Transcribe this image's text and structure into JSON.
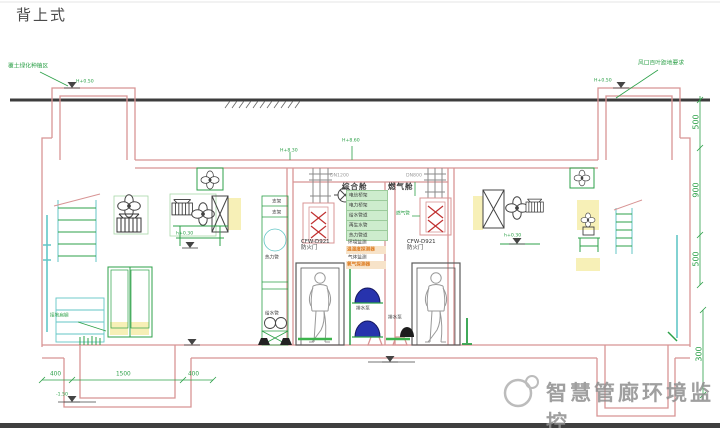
{
  "title": "背上式",
  "watermark": {
    "text": "智慧管廊环境监控"
  },
  "cabins": {
    "left": "综合舱",
    "right": "燃气舱"
  },
  "fire_door_left": {
    "model": "CFW-D921",
    "label": "防火门"
  },
  "fire_door_right": {
    "model": "CFW-D921",
    "label": "防火门"
  },
  "pipe_stack": {
    "rows": [
      "电信桥架",
      "电力桥架",
      "给水管道",
      "再生水管",
      "热力管道"
    ],
    "sensor1_label": "环境监测",
    "sensor1_value": "温湿度探测器",
    "sensor2_label": "气体监测",
    "sensor2_value": "氧气探测器"
  },
  "equipment_labels": {
    "rack1": "支架",
    "rack2": "支架",
    "pipe_mid": "热力管",
    "pipe_low": "给水管",
    "pump1": "排水泵",
    "pump2": "排水泵",
    "grounding": "接地扁钢",
    "gas_pipe": "燃气管"
  },
  "annotations": {
    "top_left": "覆土绿化种植区",
    "top_left_elev": "H+0.50",
    "top_right": "风口百叶距地要求",
    "top_right_elev": "H+0.50",
    "roof_elev_1": "H+8.30",
    "roof_elev_2": "H+8.60",
    "dn_left": "DN1200",
    "dn_right": "DN800",
    "platform_left": "h+0.30",
    "platform_right": "h+0.30",
    "pit_elev_left": "-1.50"
  },
  "dimensions": {
    "bottom_left": [
      "400",
      "1500",
      "400"
    ],
    "right_chain": [
      "500",
      "900",
      "500"
    ],
    "right_lower": "300"
  },
  "colors": {
    "wall": "#d89494",
    "annotation": "#2ca048",
    "valve": "#c03030",
    "dome": "#2733ad",
    "highlight": "#f6edaa",
    "orange": "#dd7a1e",
    "ground": "#3c3c3c",
    "teal": "#63c6c6"
  }
}
